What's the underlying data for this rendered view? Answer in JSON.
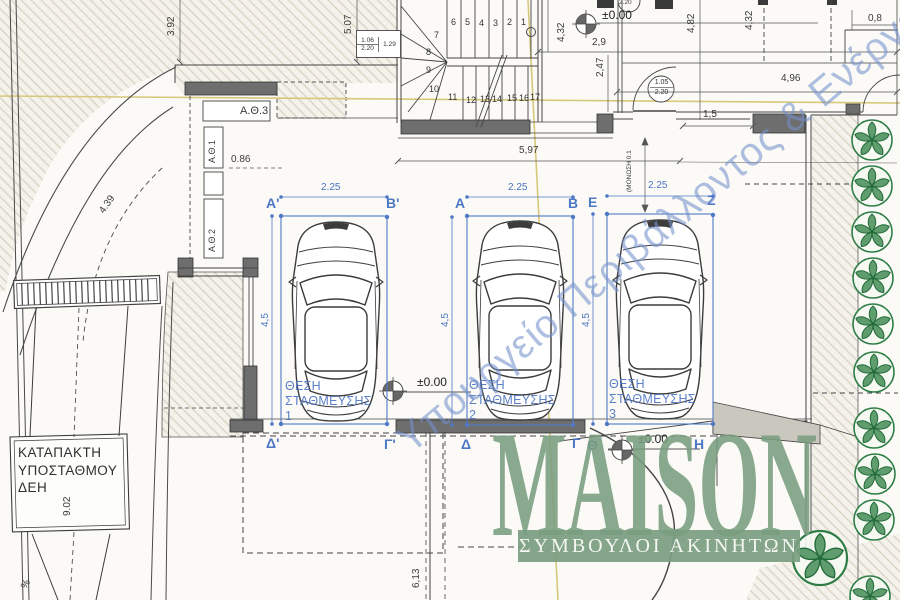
{
  "drawing": {
    "levels": {
      "top": "±0.00",
      "middle": "±0.00",
      "bottom": "±0.00"
    },
    "dims": {
      "w392": "3.92",
      "w507": "5.07",
      "h432_stair": "4,32",
      "w29": "2,9",
      "h247": "2,47",
      "h482": "4,82",
      "h432_right": "4,32",
      "w08": "0,8",
      "w496": "4,96",
      "w15": "1,5",
      "w597": "5,97",
      "insulation": "(ΜΟΝΩΣΗ 0.1",
      "entry": "0.86",
      "radius": "4.39",
      "shaft": "9.02",
      "below": "6,13",
      "slope": "%",
      "stall_width": "2.25",
      "stall_depth": "4,5"
    },
    "door_tags": {
      "main_top": "1.06",
      "main_bottom": "2.20",
      "main_side": "1.29",
      "circle_top": "1.05",
      "circle_bottom": "2.20",
      "clipped": "2.20"
    },
    "rooms": {
      "ath1": "Α.Θ.1",
      "ath2": "Α.Θ.2",
      "ath3": "Α.Θ.3"
    },
    "shaft_box": {
      "line1": "ΚΑΤΑΠΑΚΤΗ",
      "line2": "ΥΠΟΣΤΑΘΜΟΥ",
      "line3": "ΔΕΗ"
    },
    "stairs": {
      "steps": [
        "1",
        "2",
        "3",
        "4",
        "5",
        "6",
        "7",
        "8",
        "9",
        "10",
        "11",
        "12",
        "13",
        "14",
        "15",
        "16",
        "17"
      ]
    },
    "parking": {
      "spaces": [
        {
          "l1": "ΘΕΣΗ",
          "l2": "ΣΤΑΘΜΕΥΣΗΣ",
          "num": "1",
          "tl": "Α'",
          "tr": "Β'",
          "bl": "Δ'",
          "br": "Γ'"
        },
        {
          "l1": "ΘΕΣΗ",
          "l2": "ΣΤΑΘΜΕΥΣΗΣ",
          "num": "2",
          "tl": "Α",
          "tr": "Β",
          "bl": "Δ",
          "br": "Γ"
        },
        {
          "l1": "ΘΕΣΗ",
          "l2": "ΣΤΑΘΜΕΥΣΗΣ",
          "num": "3",
          "tl": "Ε",
          "tr": "Ζ",
          "bl": "Θ",
          "br": "Η"
        }
      ]
    }
  },
  "watermark": {
    "text": "Υπουργείο Περιβάλλοντος & Ενέργειας"
  },
  "logo": {
    "brand": "MAISON",
    "tagline": "ΣΥΜΒΟΥΛΟΙ ΑΚΙΝΗΤΩΝ"
  },
  "colors": {
    "annotation_blue": "#4a74c4",
    "logo_green": "#7d9f82",
    "tree_green": "#2e7d46",
    "axis_yellow": "#d9c97c",
    "wall_gray": "#6e6e6e",
    "watermark_blue": "#7391cd"
  }
}
